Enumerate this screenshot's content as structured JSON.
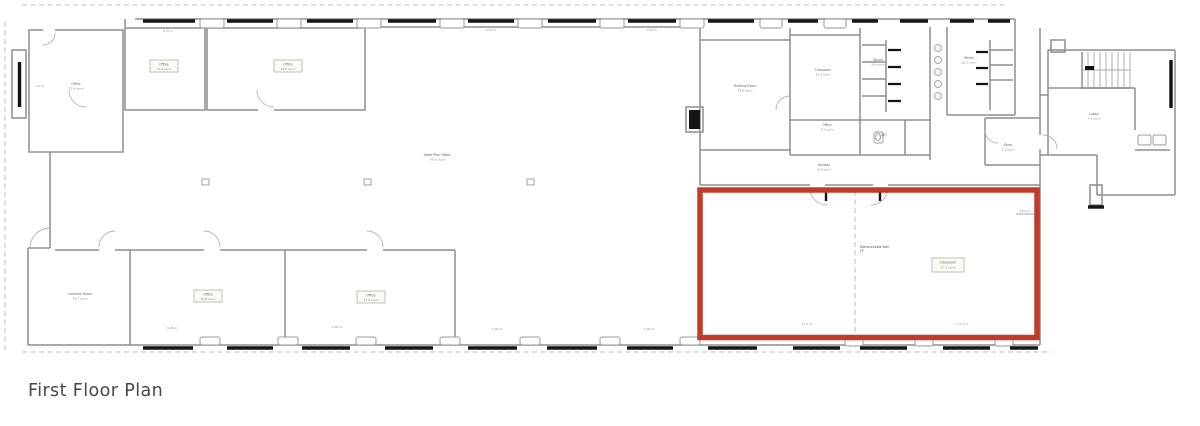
{
  "title": "First Floor Plan",
  "highlight": {
    "color": "#c13b2b"
  },
  "labels": {
    "room_tl_name": "Office",
    "room_tl_area": "21.4 sq m",
    "room_tl_side": "3.2 m",
    "room_t2_name": "Office",
    "room_t2_area": "13.2 sq m",
    "room_t3_name": "Office",
    "room_t3_area": "18.6 sq m",
    "open_name": "Open Plan Office",
    "open_area": "176.0 sq m",
    "dim_t1": "4.70 m",
    "dim_t2": "4.70 m",
    "dim_t3": "4.70 m",
    "dim_b1": "3.95 m",
    "dim_b2": "3.95 m",
    "dim_b3": "3.95 m",
    "dim_b4": "3.95 m",
    "dim_r1": "17.1 m",
    "dim_r2": "17.1 m",
    "dim_corner": "12.0 m",
    "bl1_name": "Common Room",
    "bl1_area": "28.3 sq m",
    "bl2_name": "Office",
    "bl2_area": "16.8 sq m",
    "bl3_name": "Office",
    "bl3_area": "17.5 sq m",
    "r1_name": "Meeting Room",
    "r1_area": "24.6 sq m",
    "r2_name": "Classroom",
    "r2_area": "15.2 sq m",
    "wc1_name": "Toilets",
    "wc1_area": "9.8 sq m",
    "wc2_name": "Toilets",
    "wc2_area": "10.2 sq m",
    "off2_name": "Office",
    "off2_area": "6.1 sq m",
    "wc3_name": "WC",
    "hall_name": "Hallway",
    "hall_area": "8.9 sq m",
    "store_name": "Store",
    "store_area": "4.2 sq m",
    "lobby_name": "Lobby",
    "lobby_area": "7.4 sq m",
    "demount_l1": "Demountable wall",
    "demount_l2": "FF",
    "red_name": "Classroom",
    "red_area": "57.5 sq m"
  }
}
